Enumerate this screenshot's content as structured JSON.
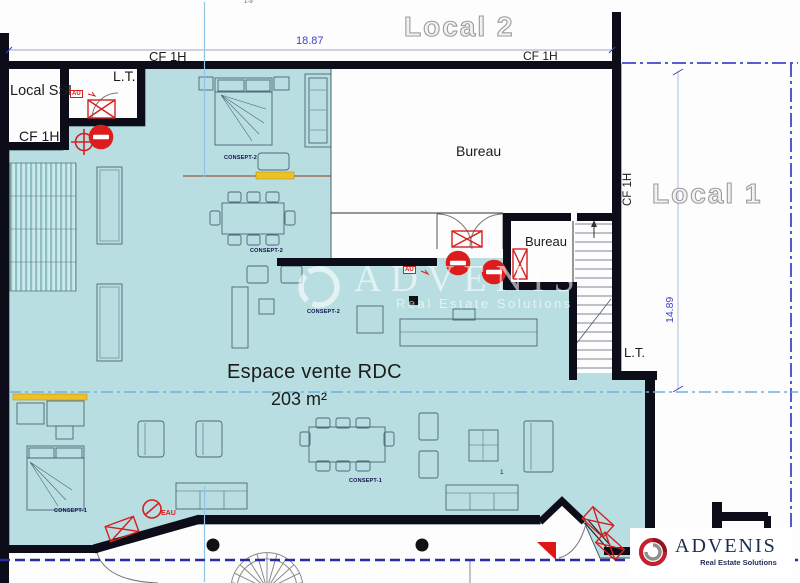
{
  "labels": {
    "scale_note": "1-9",
    "local_2": "Local 2",
    "local_1": "Local 1",
    "local_ssi": "Local SSI",
    "lt": "L.T.",
    "cf_1h": "CF 1H",
    "bureau": "Bureau",
    "espace_title": "Espace vente RDC",
    "espace_area": "203 m²",
    "dim_width": "18.87",
    "dim_height": "14.89",
    "au": "AU",
    "eau": "EAU",
    "concept_2": "CONSEPT-2",
    "concept_1": "CONSEPT-1",
    "unit_one": "1"
  },
  "watermark": {
    "brand": "ADVENIS",
    "tagline": "Real Estate Solutions"
  },
  "logo": {
    "brand": "ADVENIS",
    "tagline": "Real Estate Solutions"
  },
  "colors": {
    "floor": "#b9dee1",
    "wall": "#0d0d1a",
    "dimension_blue": "#3d44c8",
    "axis_blue": "#6fb0e0",
    "alert_red": "#d42020",
    "highlight_yellow": "#eec227",
    "brand_red": "#c32030",
    "brand_navy": "#1c2b4e"
  },
  "icons": {
    "no_entry": "red circle with white bar",
    "condemned_opening": "red rectangle with X",
    "water_shutoff": "red slashed circle + EAU",
    "column": "black dot",
    "entrance_marker": "red triangle",
    "stairs": "treads with direction arrow"
  }
}
